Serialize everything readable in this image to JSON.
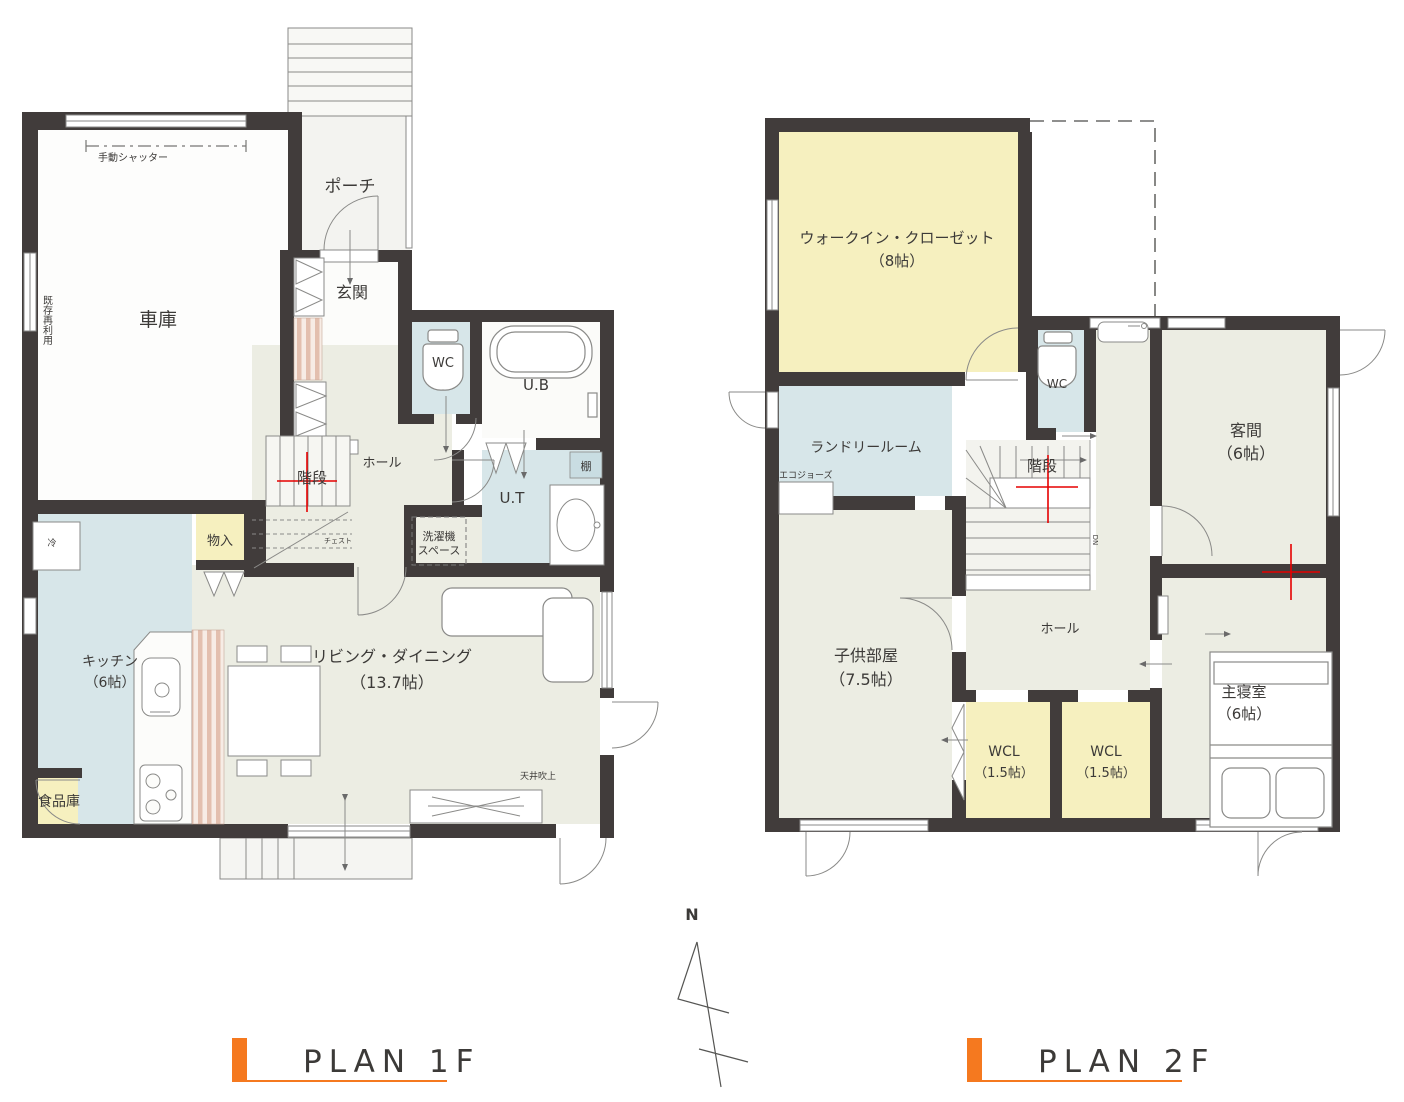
{
  "plan1f": {
    "title": "PLAN 1F",
    "rooms": {
      "porch": "ポーチ",
      "garage": "車庫",
      "entrance": "玄関",
      "hall": "ホール",
      "wc": "WC",
      "bath": "U.B",
      "ut": "U.T",
      "stairs": "階段",
      "storage": "物入",
      "kitchen_name": "キッチン",
      "kitchen_size": "（6帖）",
      "living_name": "リビング・ダイニング",
      "living_size": "（13.7帖）",
      "pantry": "食品庫"
    },
    "annotations": {
      "shutter": "手動シャッター",
      "reuse": "既存再利用",
      "washer_line1": "洗濯機",
      "washer_line2": "スペース",
      "shelf": "棚",
      "chest": "チェスト",
      "fridge": "冷",
      "ceiling": "天井吹上"
    }
  },
  "plan2f": {
    "title": "PLAN 2F",
    "rooms": {
      "wic_name": "ウォークイン・クローゼット",
      "wic_size": "（8帖）",
      "wc": "WC",
      "guest_name": "客間",
      "guest_size": "（6帖）",
      "laundry": "ランドリールーム",
      "stairs": "階段",
      "kids_name": "子供部屋",
      "kids_size": "（7.5帖）",
      "hall": "ホール",
      "wcl1_name": "WCL",
      "wcl1_size": "（1.5帖）",
      "wcl2_name": "WCL",
      "wcl2_size": "（1.5帖）",
      "master_name": "主寝室",
      "master_size": "（6帖）"
    },
    "annotations": {
      "ecojozu": "エコジョーズ",
      "down": "DN"
    }
  },
  "compass": {
    "north": "N"
  },
  "colors": {
    "wall": "#413c3b",
    "accent_orange": "#f5791f",
    "title_text": "#b0a55c",
    "room_ivory": "#ecede3",
    "room_blue": "#d7e6e9",
    "room_yellow": "#f6f0bf",
    "mark_red": "#e60000"
  }
}
